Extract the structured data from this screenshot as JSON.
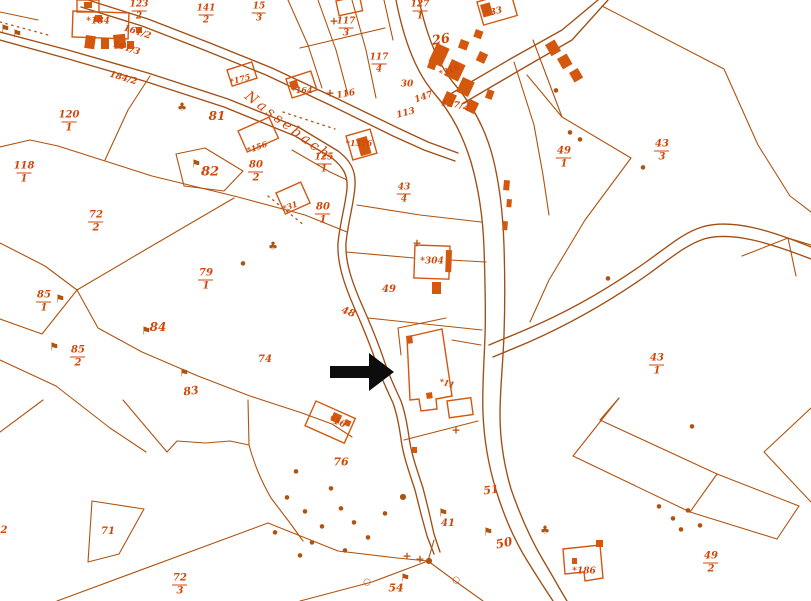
{
  "palette": {
    "bg": "#ffffff",
    "ink": "#b0530f",
    "ink2": "#a14e14",
    "building": "#d4570e",
    "text": "#d04708",
    "arrow": "#0d0d0d"
  },
  "stream": {
    "name": "Nassebach"
  },
  "annotation": {
    "arrow_direction": "right"
  },
  "marker_glyphs": {
    "flag": "⚑",
    "tree": "♣",
    "cross": "+",
    "dot": "●",
    "stone": "●",
    "circle": "○"
  },
  "parcel_labels": [
    {
      "text": "123/2",
      "kind": "frac",
      "x": 139,
      "y": 11,
      "rot": 0,
      "size": 9
    },
    {
      "text": "141/2",
      "kind": "frac",
      "x": 206,
      "y": 15,
      "rot": 0,
      "size": 9
    },
    {
      "text": "15/3",
      "kind": "frac",
      "x": 259,
      "y": 13,
      "rot": 0,
      "size": 9
    },
    {
      "text": "127/1",
      "kind": "frac",
      "x": 420,
      "y": 11,
      "rot": 0,
      "size": 9
    },
    {
      "text": "117/3",
      "kind": "frac",
      "x": 346,
      "y": 28,
      "rot": 0,
      "size": 9
    },
    {
      "text": "117/4",
      "kind": "frac",
      "x": 379,
      "y": 64,
      "rot": 0,
      "size": 9
    },
    {
      "text": "120/1",
      "kind": "frac",
      "x": 69,
      "y": 122,
      "rot": 0,
      "size": 10
    },
    {
      "text": "118/1",
      "kind": "frac",
      "x": 24,
      "y": 173,
      "rot": 0,
      "size": 10
    },
    {
      "text": "125/1",
      "kind": "frac",
      "x": 324,
      "y": 164,
      "rot": 0,
      "size": 9
    },
    {
      "text": "43/4",
      "kind": "frac",
      "x": 404,
      "y": 194,
      "rot": 0,
      "size": 9
    },
    {
      "text": "80/1",
      "kind": "frac",
      "x": 323,
      "y": 214,
      "rot": 0,
      "size": 10
    },
    {
      "text": "80/2",
      "kind": "frac",
      "x": 256,
      "y": 172,
      "rot": 0,
      "size": 10
    },
    {
      "text": "72/2",
      "kind": "frac",
      "x": 96,
      "y": 222,
      "rot": 0,
      "size": 10
    },
    {
      "text": "79/1",
      "kind": "frac",
      "x": 206,
      "y": 280,
      "rot": 0,
      "size": 10
    },
    {
      "text": "85/1",
      "kind": "frac",
      "x": 44,
      "y": 302,
      "rot": 0,
      "size": 10
    },
    {
      "text": "85/2",
      "kind": "frac",
      "x": 78,
      "y": 357,
      "rot": 0,
      "size": 10
    },
    {
      "text": "43/3",
      "kind": "frac",
      "x": 662,
      "y": 151,
      "rot": 0,
      "size": 10
    },
    {
      "text": "49/1",
      "kind": "frac",
      "x": 564,
      "y": 158,
      "rot": 0,
      "size": 10
    },
    {
      "text": "43/1",
      "kind": "frac",
      "x": 657,
      "y": 365,
      "rot": 0,
      "size": 10
    },
    {
      "text": "72/3",
      "kind": "frac",
      "x": 180,
      "y": 585,
      "rot": 0,
      "size": 10
    },
    {
      "text": "49/2",
      "kind": "frac",
      "x": 711,
      "y": 563,
      "rot": 0,
      "size": 10
    },
    {
      "text": "161/2",
      "kind": "plain",
      "x": 137,
      "y": 33,
      "rot": 18,
      "size": 9
    },
    {
      "text": "161/3",
      "kind": "plain",
      "x": 126,
      "y": 49,
      "rot": 18,
      "size": 9
    },
    {
      "text": "184/2",
      "kind": "plain",
      "x": 123,
      "y": 79,
      "rot": 16,
      "size": 9
    },
    {
      "text": "127/2",
      "kind": "plain",
      "x": 455,
      "y": 106,
      "rot": 8,
      "size": 9
    },
    {
      "text": "147",
      "kind": "plain",
      "x": 424,
      "y": 98,
      "rot": -20,
      "size": 9
    },
    {
      "text": "30",
      "kind": "plain",
      "x": 407,
      "y": 85,
      "rot": 0,
      "size": 9
    },
    {
      "text": "26",
      "kind": "plain",
      "x": 441,
      "y": 40,
      "rot": -10,
      "size": 13
    },
    {
      "text": "116",
      "kind": "plain",
      "x": 346,
      "y": 95,
      "rot": -10,
      "size": 9
    },
    {
      "text": "113",
      "kind": "plain",
      "x": 406,
      "y": 114,
      "rot": -15,
      "size": 9
    },
    {
      "text": "81",
      "kind": "plain",
      "x": 217,
      "y": 116,
      "rot": 0,
      "size": 12
    },
    {
      "text": "82",
      "kind": "plain",
      "x": 210,
      "y": 172,
      "rot": 0,
      "size": 13
    },
    {
      "text": "84",
      "kind": "plain",
      "x": 158,
      "y": 327,
      "rot": 0,
      "size": 12
    },
    {
      "text": "83",
      "kind": "plain",
      "x": 191,
      "y": 391,
      "rot": -8,
      "size": 11
    },
    {
      "text": "74",
      "kind": "plain",
      "x": 265,
      "y": 360,
      "rot": 0,
      "size": 10
    },
    {
      "text": "49",
      "kind": "plain",
      "x": 389,
      "y": 290,
      "rot": 0,
      "size": 10
    },
    {
      "text": "48",
      "kind": "plain",
      "x": 348,
      "y": 313,
      "rot": 20,
      "size": 10
    },
    {
      "text": "76",
      "kind": "plain",
      "x": 341,
      "y": 462,
      "rot": 0,
      "size": 11
    },
    {
      "text": "51",
      "kind": "plain",
      "x": 491,
      "y": 490,
      "rot": -8,
      "size": 11
    },
    {
      "text": "50",
      "kind": "plain",
      "x": 504,
      "y": 543,
      "rot": -12,
      "size": 12
    },
    {
      "text": "41",
      "kind": "plain",
      "x": 448,
      "y": 524,
      "rot": 0,
      "size": 10
    },
    {
      "text": "54",
      "kind": "plain",
      "x": 396,
      "y": 588,
      "rot": 0,
      "size": 11
    },
    {
      "text": "71",
      "kind": "plain",
      "x": 108,
      "y": 532,
      "rot": 0,
      "size": 10
    },
    {
      "text": "2",
      "kind": "plain",
      "x": 4,
      "y": 531,
      "rot": 0,
      "size": 10
    },
    {
      "text": "*184",
      "kind": "building",
      "x": 98,
      "y": 22,
      "rot": 0,
      "size": 9
    },
    {
      "text": "*175",
      "kind": "building",
      "x": 240,
      "y": 79,
      "rot": -15,
      "size": 8
    },
    {
      "text": "*156",
      "kind": "building",
      "x": 257,
      "y": 147,
      "rot": -20,
      "size": 8
    },
    {
      "text": "*164",
      "kind": "building",
      "x": 302,
      "y": 90,
      "rot": 0,
      "size": 8
    },
    {
      "text": "*31",
      "kind": "building",
      "x": 290,
      "y": 206,
      "rot": -20,
      "size": 8
    },
    {
      "text": "*1376",
      "kind": "building",
      "x": 359,
      "y": 143,
      "rot": 0,
      "size": 8
    },
    {
      "text": "*316",
      "kind": "building",
      "x": 449,
      "y": 70,
      "rot": -20,
      "size": 8
    },
    {
      "text": "*33",
      "kind": "building",
      "x": 494,
      "y": 13,
      "rot": -14,
      "size": 9
    },
    {
      "text": "*304",
      "kind": "building",
      "x": 432,
      "y": 262,
      "rot": 0,
      "size": 9
    },
    {
      "text": "*11",
      "kind": "building",
      "x": 447,
      "y": 383,
      "rot": 15,
      "size": 8
    },
    {
      "text": "*16",
      "kind": "building",
      "x": 337,
      "y": 423,
      "rot": 22,
      "size": 9
    },
    {
      "text": "*186",
      "kind": "building",
      "x": 584,
      "y": 572,
      "rot": 0,
      "size": 9
    },
    {
      "text": "Nassebach",
      "kind": "stream",
      "x": 288,
      "y": 126,
      "rot": 37,
      "size": 14
    }
  ],
  "markers": [
    {
      "kind": "flag",
      "x": 60,
      "y": 299
    },
    {
      "kind": "flag",
      "x": 146,
      "y": 331
    },
    {
      "kind": "flag",
      "x": 54,
      "y": 347
    },
    {
      "kind": "flag",
      "x": 184,
      "y": 373
    },
    {
      "kind": "flag",
      "x": 196,
      "y": 164
    },
    {
      "kind": "flag",
      "x": 488,
      "y": 532
    },
    {
      "kind": "flag",
      "x": 443,
      "y": 513
    },
    {
      "kind": "flag",
      "x": 405,
      "y": 578
    },
    {
      "kind": "flag",
      "x": 5,
      "y": 29
    },
    {
      "kind": "flag",
      "x": 17,
      "y": 34
    },
    {
      "kind": "cross",
      "x": 334,
      "y": 21
    },
    {
      "kind": "cross",
      "x": 417,
      "y": 243
    },
    {
      "kind": "cross",
      "x": 407,
      "y": 556
    },
    {
      "kind": "cross",
      "x": 420,
      "y": 559
    },
    {
      "kind": "cross",
      "x": 456,
      "y": 430
    },
    {
      "kind": "cross",
      "x": 330,
      "y": 93
    },
    {
      "kind": "dot",
      "x": 287,
      "y": 498
    },
    {
      "kind": "dot",
      "x": 305,
      "y": 512
    },
    {
      "kind": "dot",
      "x": 322,
      "y": 527
    },
    {
      "kind": "dot",
      "x": 341,
      "y": 509
    },
    {
      "kind": "dot",
      "x": 312,
      "y": 543
    },
    {
      "kind": "dot",
      "x": 354,
      "y": 523
    },
    {
      "kind": "dot",
      "x": 296,
      "y": 472
    },
    {
      "kind": "dot",
      "x": 331,
      "y": 489
    },
    {
      "kind": "dot",
      "x": 368,
      "y": 538
    },
    {
      "kind": "dot",
      "x": 385,
      "y": 514
    },
    {
      "kind": "dot",
      "x": 300,
      "y": 556
    },
    {
      "kind": "dot",
      "x": 345,
      "y": 551
    },
    {
      "kind": "dot",
      "x": 275,
      "y": 533
    },
    {
      "kind": "dot",
      "x": 243,
      "y": 264
    },
    {
      "kind": "dot",
      "x": 608,
      "y": 279
    },
    {
      "kind": "dot",
      "x": 692,
      "y": 427
    },
    {
      "kind": "dot",
      "x": 556,
      "y": 91
    },
    {
      "kind": "dot",
      "x": 643,
      "y": 168
    },
    {
      "kind": "dot",
      "x": 659,
      "y": 507
    },
    {
      "kind": "dot",
      "x": 673,
      "y": 519
    },
    {
      "kind": "dot",
      "x": 688,
      "y": 511
    },
    {
      "kind": "dot",
      "x": 700,
      "y": 526
    },
    {
      "kind": "dot",
      "x": 681,
      "y": 530
    },
    {
      "kind": "dot",
      "x": 570,
      "y": 133
    },
    {
      "kind": "dot",
      "x": 580,
      "y": 140
    },
    {
      "kind": "stone",
      "x": 429,
      "y": 561
    },
    {
      "kind": "stone",
      "x": 403,
      "y": 497
    },
    {
      "kind": "circle",
      "x": 367,
      "y": 583
    },
    {
      "kind": "circle",
      "x": 456,
      "y": 581
    },
    {
      "kind": "tree",
      "x": 545,
      "y": 530
    },
    {
      "kind": "tree",
      "x": 182,
      "y": 107
    },
    {
      "kind": "tree",
      "x": 273,
      "y": 246
    }
  ]
}
